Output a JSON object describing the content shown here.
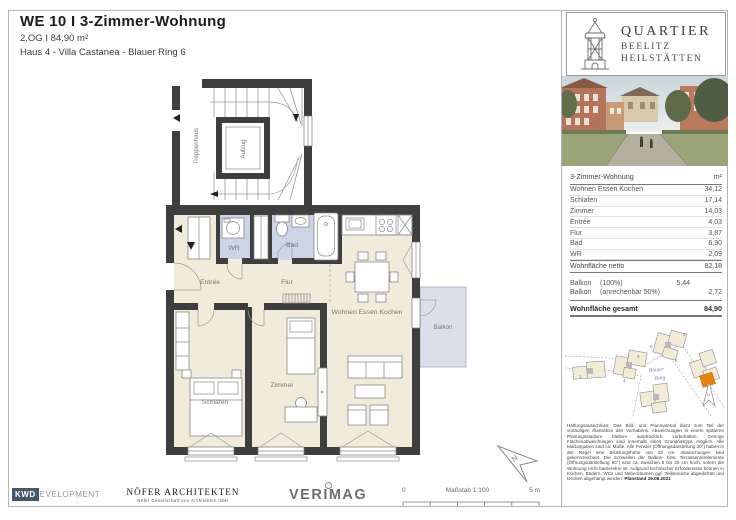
{
  "header": {
    "title": "WE 10 I 3-Zimmer-Wohnung",
    "subtitle": "2.OG I 84,90 m²",
    "address": "Haus 4 - Villa Castanea - Blauer Ring 6"
  },
  "brand": {
    "name_line1": "QUARTIER",
    "name_line2": "BEELITZ",
    "name_line3": "HEILSTÄTTEN"
  },
  "area_table": {
    "col_label": "3-Zimmer-Wohnung",
    "col_unit": "m²",
    "rooms": [
      {
        "label": "Wohnen Essen Kochen",
        "value": "34,12"
      },
      {
        "label": "Schlafen",
        "value": "17,14"
      },
      {
        "label": "Zimmer",
        "value": "14,03"
      },
      {
        "label": "Entrée",
        "value": "4,03"
      },
      {
        "label": "Flur",
        "value": "3,87"
      },
      {
        "label": "Bad",
        "value": "6,90"
      },
      {
        "label": "WR",
        "value": "2,09"
      }
    ],
    "netto_label": "Wohnfläche netto",
    "netto_value": "82,18",
    "balkon": [
      {
        "label": "Balkon",
        "note": "(100%)",
        "mid": "5,44",
        "value": ""
      },
      {
        "label": "Balkon",
        "note": "(anrechenbar 50%)",
        "mid": "",
        "value": "2,72"
      }
    ],
    "gesamt_label": "Wohnfläche gesamt",
    "gesamt_value": "84,90"
  },
  "floorplan": {
    "labels": {
      "treppenhaus": "Treppenhaus",
      "aufzug": "Aufzug",
      "wr": "WR",
      "bad": "Bad",
      "entree": "Entrée",
      "flur": "Flur",
      "wohnen": "Wohnen Essen Kochen",
      "schlafen": "Schlafen",
      "zimmer": "Zimmer",
      "balkon": "Balkon"
    },
    "north": "N"
  },
  "site_plan": {
    "street_line1": "Blauer",
    "street_line2": "Ring",
    "north": "N",
    "numbers": [
      "1",
      "2",
      "3",
      "4",
      "5",
      "6"
    ]
  },
  "disclaimer": {
    "text": "Haftungsausschluss: Das Bild- und Planmaterial dient zum Teil der vorläufigen Illustration des Vorhabens. Abweichungen in einem späteren Planungsstadium bleiben ausdrücklich vorbehalten. Geringe Flächenabweichungen sind innerhalb eines Grundrisstyps möglich. Alle Maßangaben sind ca. Maße. Alle Fenster (Öffnungsdarstellung 30°) haben in der Regel eine Brüstungshöhe von 82 cm. Abweichungen sind gekennzeichnet. Die Schwellen der Balkon- bzw. Terrassentürelemente (Öffnungsdarstellung 90°) sind ca. zwischen 5 bis 20 cm hoch, sofern die Wohnung nicht barrierefrei ist. Aufgrund technischer Erfordernisse können in Küchen, Bädern, WCs und Nebenräumen ggf. Teilbereiche abgedichtet und Decken abgehängt werden.",
    "planstand": "Planstand 19.08.2021"
  },
  "footer": {
    "kwd_box": "KWD",
    "kwd_rest": "EVELOPMENT",
    "noefer_title": "NÖFER ARCHITEKTEN",
    "noefer_sub": "Nöfer Gesellschaft von Architekten mbH",
    "verimag": "VERIMAG",
    "scale_zero": "0",
    "scale_label": "Maßstab 1:100",
    "scale_end": "5 m"
  },
  "colors": {
    "wall": "#3e3e3e",
    "floor": "#f0ebda",
    "wet": "#ccd4e6",
    "balcony": "#dcdfe9",
    "highlight": "#e8830c",
    "line": "#8a8a8a",
    "street_label": "#7080a5",
    "kwd_blue": "#47576a"
  }
}
